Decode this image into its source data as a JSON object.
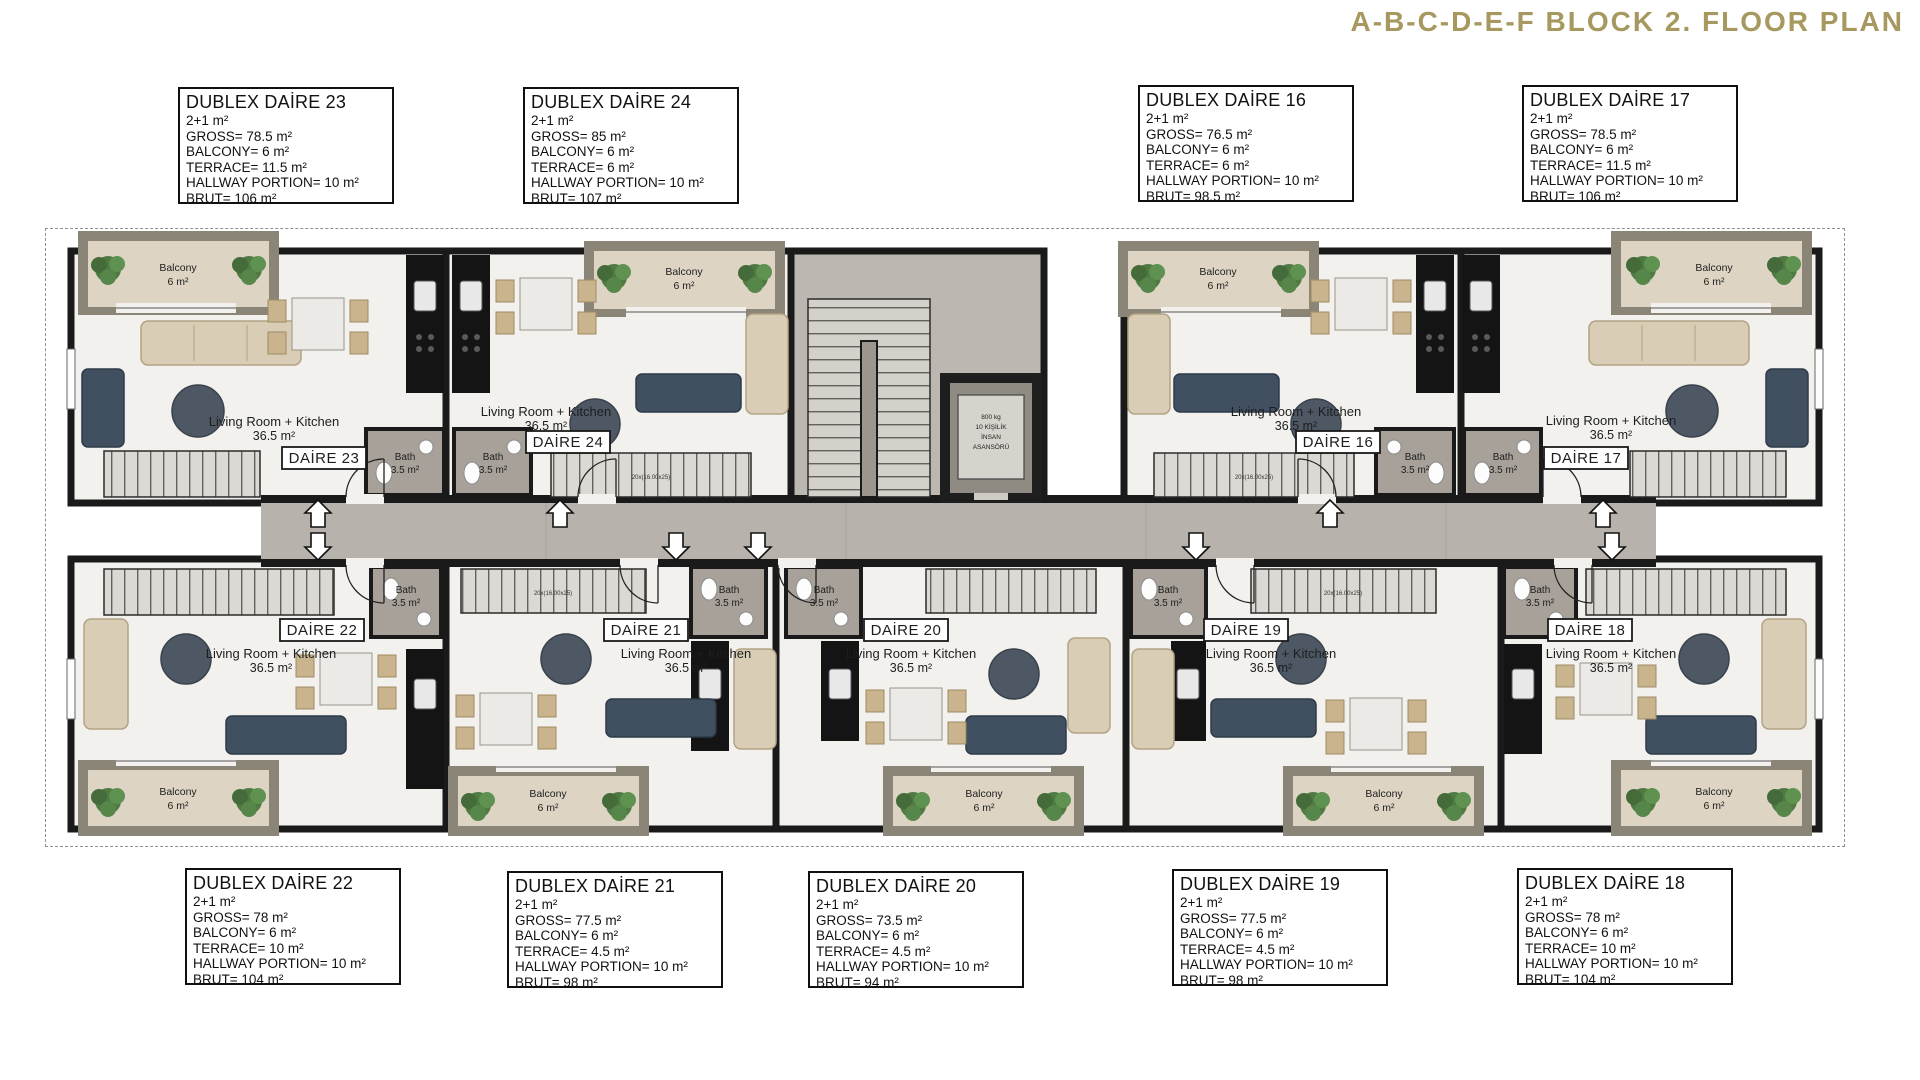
{
  "title": "A-B-C-D-E-F BLOCK 2. FLOOR PLAN",
  "colors": {
    "accent_gold": "#a6985e",
    "wall_black": "#1a1a1a",
    "floor_light": "#f2f1ee",
    "corridor_gray": "#b7b3ac",
    "balcony_beige": "#ddd4c4",
    "balcony_rim": "#8b8577",
    "bath_gray": "#a7a199",
    "kitchen_dark": "#141414",
    "sofa_beige": "#d9cdb6",
    "sofa_navy": "#415061",
    "table_dark": "#4e5864",
    "plant_green": "#4f7a42"
  },
  "info": {
    "top": [
      {
        "title": "DUBLEX DAİRE 23",
        "lines": [
          "2+1 m²",
          "GROSS= 78.5 m²",
          "BALCONY= 6 m²",
          "TERRACE= 11.5 m²",
          "HALLWAY PORTION= 10 m²",
          "BRUT= 106 m²"
        ]
      },
      {
        "title": "DUBLEX DAİRE 24",
        "lines": [
          "2+1 m²",
          "GROSS= 85 m²",
          "BALCONY= 6 m²",
          "TERRACE= 6 m²",
          "HALLWAY PORTION= 10 m²",
          "BRUT= 107 m²"
        ]
      },
      {
        "title": "DUBLEX DAİRE 16",
        "lines": [
          "2+1 m²",
          "GROSS= 76.5 m²",
          "BALCONY= 6 m²",
          "TERRACE= 6 m²",
          "HALLWAY PORTION= 10 m²",
          "BRUT= 98.5 m²"
        ]
      },
      {
        "title": "DUBLEX DAİRE 17",
        "lines": [
          "2+1 m²",
          "GROSS= 78.5 m²",
          "BALCONY= 6 m²",
          "TERRACE= 11.5 m²",
          "HALLWAY PORTION= 10 m²",
          "BRUT= 106 m²"
        ]
      }
    ],
    "bottom": [
      {
        "title": "DUBLEX DAİRE 22",
        "lines": [
          "2+1 m²",
          "GROSS= 78 m²",
          "BALCONY= 6 m²",
          "TERRACE= 10 m²",
          "HALLWAY PORTION= 10 m²",
          "BRUT= 104 m²"
        ]
      },
      {
        "title": "DUBLEX DAİRE 21",
        "lines": [
          "2+1 m²",
          "GROSS= 77.5 m²",
          "BALCONY= 6 m²",
          "TERRACE= 4.5 m²",
          "HALLWAY PORTION= 10 m²",
          "BRUT= 98 m²"
        ]
      },
      {
        "title": "DUBLEX DAİRE 20",
        "lines": [
          "2+1 m²",
          "GROSS= 73.5 m²",
          "BALCONY= 6 m²",
          "TERRACE= 4.5 m²",
          "HALLWAY PORTION= 10 m²",
          "BRUT= 94 m²"
        ]
      },
      {
        "title": "DUBLEX DAİRE 19",
        "lines": [
          "2+1 m²",
          "GROSS= 77.5 m²",
          "BALCONY= 6 m²",
          "TERRACE= 4.5 m²",
          "HALLWAY PORTION= 10 m²",
          "BRUT= 98 m²"
        ]
      },
      {
        "title": "DUBLEX DAİRE 18",
        "lines": [
          "2+1 m²",
          "GROSS= 78 m²",
          "BALCONY= 6 m²",
          "TERRACE= 10 m²",
          "HALLWAY PORTION= 10 m²",
          "BRUT= 104 m²"
        ]
      }
    ]
  },
  "plan": {
    "stair_note": "20x(16.00x25)",
    "elevator": [
      "800 kg",
      "10 KİŞİLİK",
      "İNSAN",
      "ASANSÖRÜ"
    ],
    "units": [
      {
        "label": "DAİRE 23",
        "room": "Living Room + Kitchen",
        "area": "36.5 m²",
        "bath": "Bath",
        "bath_area": "3.5 m²",
        "balcony": "Balcony",
        "balcony_area": "6 m²"
      },
      {
        "label": "DAİRE 24",
        "room": "Living Room + Kitchen",
        "area": "36.5 m²",
        "bath": "Bath",
        "bath_area": "3.5 m²",
        "balcony": "Balcony",
        "balcony_area": "6 m²"
      },
      {
        "label": "DAİRE 16",
        "room": "Living Room + Kitchen",
        "area": "36.5 m²",
        "bath": "Bath",
        "bath_area": "3.5 m²",
        "balcony": "Balcony",
        "balcony_area": "6 m²"
      },
      {
        "label": "DAİRE 17",
        "room": "Living Room + Kitchen",
        "area": "36.5 m²",
        "bath": "Bath",
        "bath_area": "3.5 m²",
        "balcony": "Balcony",
        "balcony_area": "6 m²"
      },
      {
        "label": "DAİRE 22",
        "room": "Living Room + Kitchen",
        "area": "36.5 m²",
        "bath": "Bath",
        "bath_area": "3.5 m²",
        "balcony": "Balcony",
        "balcony_area": "6 m²"
      },
      {
        "label": "DAİRE 21",
        "room": "Living Room + Kitchen",
        "area": "36.5 m²",
        "bath": "Bath",
        "bath_area": "3.5 m²",
        "balcony": "Balcony",
        "balcony_area": "6 m²"
      },
      {
        "label": "DAİRE 20",
        "room": "Living Room + Kitchen",
        "area": "36.5 m²",
        "bath": "Bath",
        "bath_area": "3.5 m²",
        "balcony": "Balcony",
        "balcony_area": "6 m²"
      },
      {
        "label": "DAİRE 19",
        "room": "Living Room + Kitchen",
        "area": "36.5 m²",
        "bath": "Bath",
        "bath_area": "3.5 m²",
        "balcony": "Balcony",
        "balcony_area": "6 m²"
      },
      {
        "label": "DAİRE 18",
        "room": "Living Room + Kitchen",
        "area": "36.5 m²",
        "bath": "Bath",
        "bath_area": "3.5 m²",
        "balcony": "Balcony",
        "balcony_area": "6 m²"
      }
    ]
  }
}
